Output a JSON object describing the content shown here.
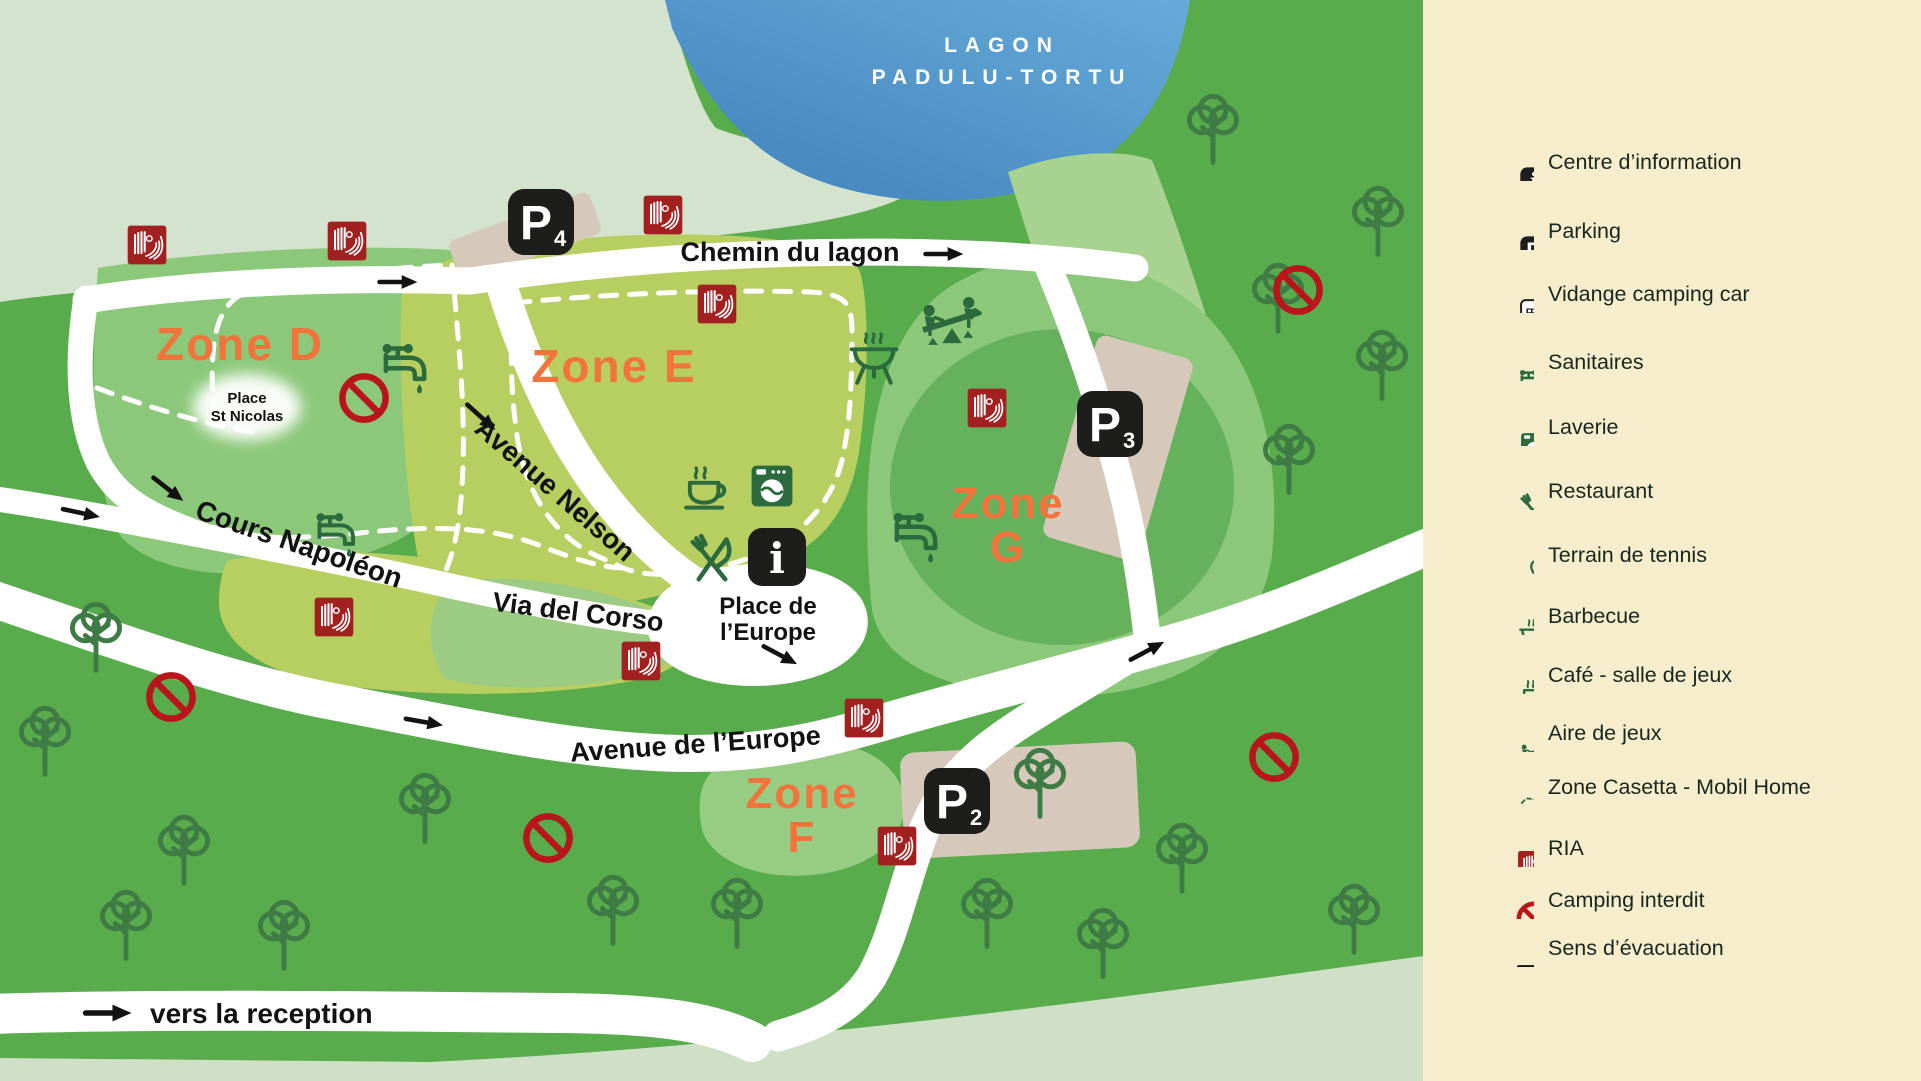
{
  "map": {
    "lagoon": {
      "line1": "LAGON",
      "line2": "PADULU-TORTU"
    },
    "zone_labels": {
      "d": "Zone D",
      "e": "Zone E",
      "g1": "Zone",
      "g2": "G",
      "f1": "Zone",
      "f2": "F"
    },
    "road_labels": {
      "chemin_du_lagon": "Chemin du lagon",
      "avenue_nelson": "Avenue Nelson",
      "cours_napoleon": "Cours Napoléon",
      "via_del_corso": "Via del Corso",
      "avenue_de_leurope": "Avenue de l’Europe",
      "vers_la_reception": "vers la reception"
    },
    "place_labels": {
      "st_nicolas1": "Place",
      "st_nicolas2": "St Nicolas",
      "europe1": "Place de",
      "europe2": "l’Europe"
    },
    "parking_signs": [
      {
        "letter": "P",
        "number": "4"
      },
      {
        "letter": "P",
        "number": "3"
      },
      {
        "letter": "P",
        "number": "2"
      }
    ]
  },
  "icons": {
    "info_glyph": "i",
    "parking_glyph": "P"
  },
  "legend": {
    "items": [
      {
        "icon": "information-sign",
        "label": "Centre d’information"
      },
      {
        "icon": "parking-sign",
        "label": "Parking"
      },
      {
        "icon": "camper-van",
        "label": "Vidange camping car"
      },
      {
        "icon": "water-tap",
        "label": "Sanitaires"
      },
      {
        "icon": "washing-machine",
        "label": "Laverie"
      },
      {
        "icon": "cutlery",
        "label": "Restaurant"
      },
      {
        "icon": "tennis-racquet",
        "label": "Terrain de tennis"
      },
      {
        "icon": "barbecue-grill",
        "label": "Barbecue"
      },
      {
        "icon": "coffee-cup",
        "label": "Café - salle de jeux"
      },
      {
        "icon": "seesaw",
        "label": "Aire de jeux"
      },
      {
        "icon": "dashed-zone",
        "label": "Zone Casetta - Mobil Home"
      },
      {
        "icon": "fire-hose-reel",
        "label": "RIA"
      },
      {
        "icon": "no-camping",
        "label": "Camping interdit"
      },
      {
        "icon": "evacuation-arrow",
        "label": "Sens d’évacuation"
      }
    ]
  },
  "colors": {
    "legend_bg": "#f6edcc",
    "water_dark": "#4181ba",
    "water_light": "#66abd9",
    "sage_green": "#d4e3ce",
    "pale_green": "#cfe0c6",
    "base_green": "#58ac4c",
    "zone_mid_green": "#8cc87a",
    "zone_yellow_green": "#b7cf61",
    "zone_dark_green": "#66b15c",
    "zone_light_green": "#a7d28f",
    "tree_outline_green": "#3e7b45",
    "icon_green": "#2a6a3d",
    "road_white": "#ffffff",
    "parking_beige": "#d6c9bb",
    "ria_red": "#a32020",
    "interdit_red": "#bb151c",
    "zone_orange": "#f2743c",
    "sign_black": "#1d1d1b",
    "legend_text": "#18271e"
  }
}
